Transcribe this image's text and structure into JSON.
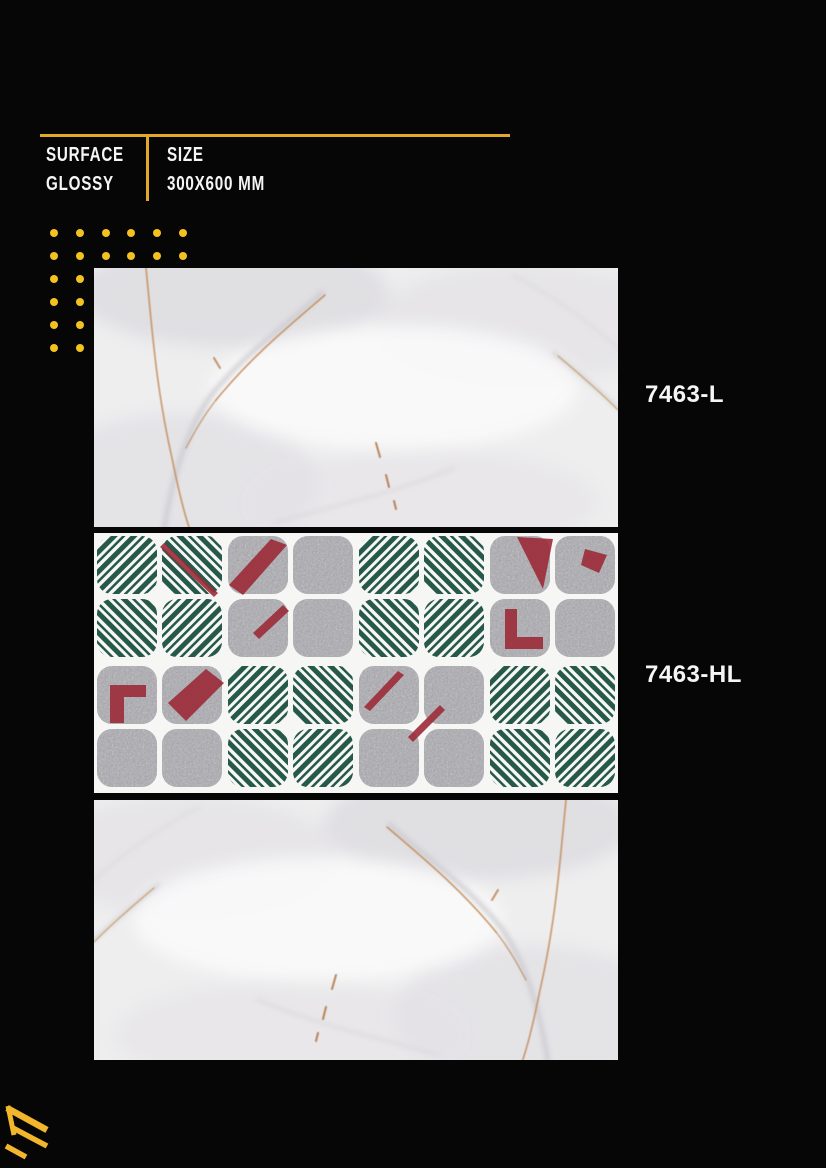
{
  "specs": {
    "surface_label": "SURFACE",
    "surface_value": "GLOSSY",
    "size_label": "SIZE",
    "size_value": "300X600 MM"
  },
  "products": [
    {
      "code": "7463-L",
      "image": "white-marble-glossy-tile-photo"
    },
    {
      "code": "7463-HL",
      "image": "green-red-grey-highlighter-decor-tile-photo"
    },
    {
      "code": "",
      "image": "white-marble-glossy-tile-photo"
    }
  ],
  "colors": {
    "background": "#060606",
    "accent_gold": "#E2A82A",
    "dot_yellow": "#F4C21E",
    "logo_gold": "#F2B62C",
    "text_white": "#F5F5F5",
    "pattern_green": "#26594A",
    "pattern_red": "#9B2B38",
    "pattern_gray": "#ACABB1",
    "marble_base": "#EFEEEF",
    "marble_vein_tan": "#C28A55"
  },
  "decor": {
    "dot_rows": 6,
    "dot_cols": 6,
    "dot_spacing_x": 25.8,
    "dot_spacing_y": 23
  },
  "highlighter_pattern": {
    "grid": [
      [
        "green",
        "gray",
        "green",
        "gray"
      ],
      [
        "gray",
        "green",
        "gray",
        "green"
      ]
    ],
    "accents": [
      {
        "row": 0,
        "col": 0,
        "shapes": [
          "red-hairline"
        ]
      },
      {
        "row": 0,
        "col": 1,
        "shapes": [
          "red-slash",
          "red-streak-bl"
        ]
      },
      {
        "row": 0,
        "col": 3,
        "shapes": [
          "red-triangle",
          "red-L-bl",
          "red-mark-tr"
        ]
      },
      {
        "row": 1,
        "col": 0,
        "shapes": [
          "red-L",
          "red-band"
        ]
      },
      {
        "row": 1,
        "col": 2,
        "shapes": [
          "red-slash-thin"
        ]
      }
    ]
  }
}
